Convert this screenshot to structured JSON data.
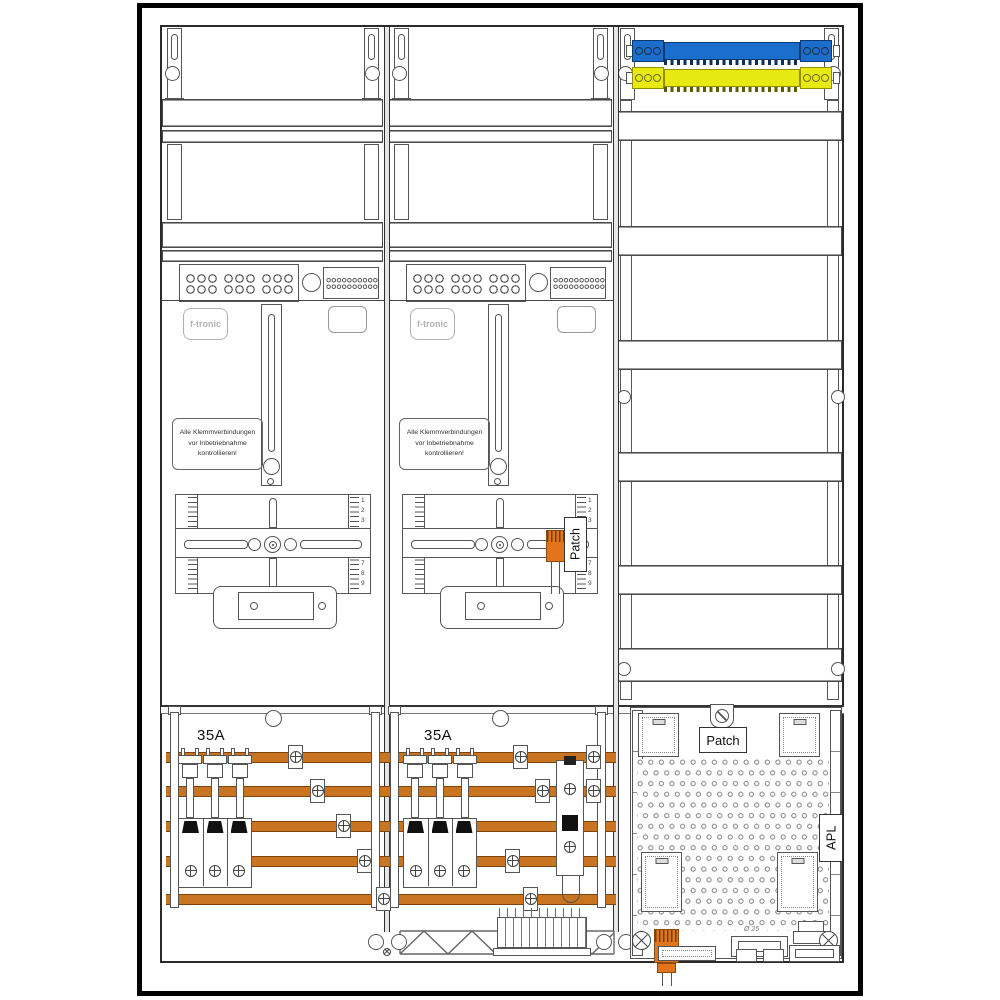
{
  "cabinet": {
    "brand": "f-tronic",
    "warning": {
      "line1": "Alle Klemmverbindungen",
      "line2": "vor Inbetriebnahme",
      "line3": "kontrollieren!"
    },
    "breaker_rating": "35A",
    "patch_module_label": "Patch",
    "patch_panel_label": "Patch",
    "apl_label": "APL",
    "gland_note": "Ø 25",
    "meter_scale": {
      "top": [
        "1",
        "2",
        "3"
      ],
      "bottom": [
        "7",
        "8",
        "9"
      ]
    },
    "colors": {
      "busbar_copper": "#C87420",
      "component_orange": "#E2751C",
      "neutral_busbar_blue": "#1B6ECC",
      "pe_busbar_yellow": "#E9E912",
      "line": "#444444"
    }
  }
}
